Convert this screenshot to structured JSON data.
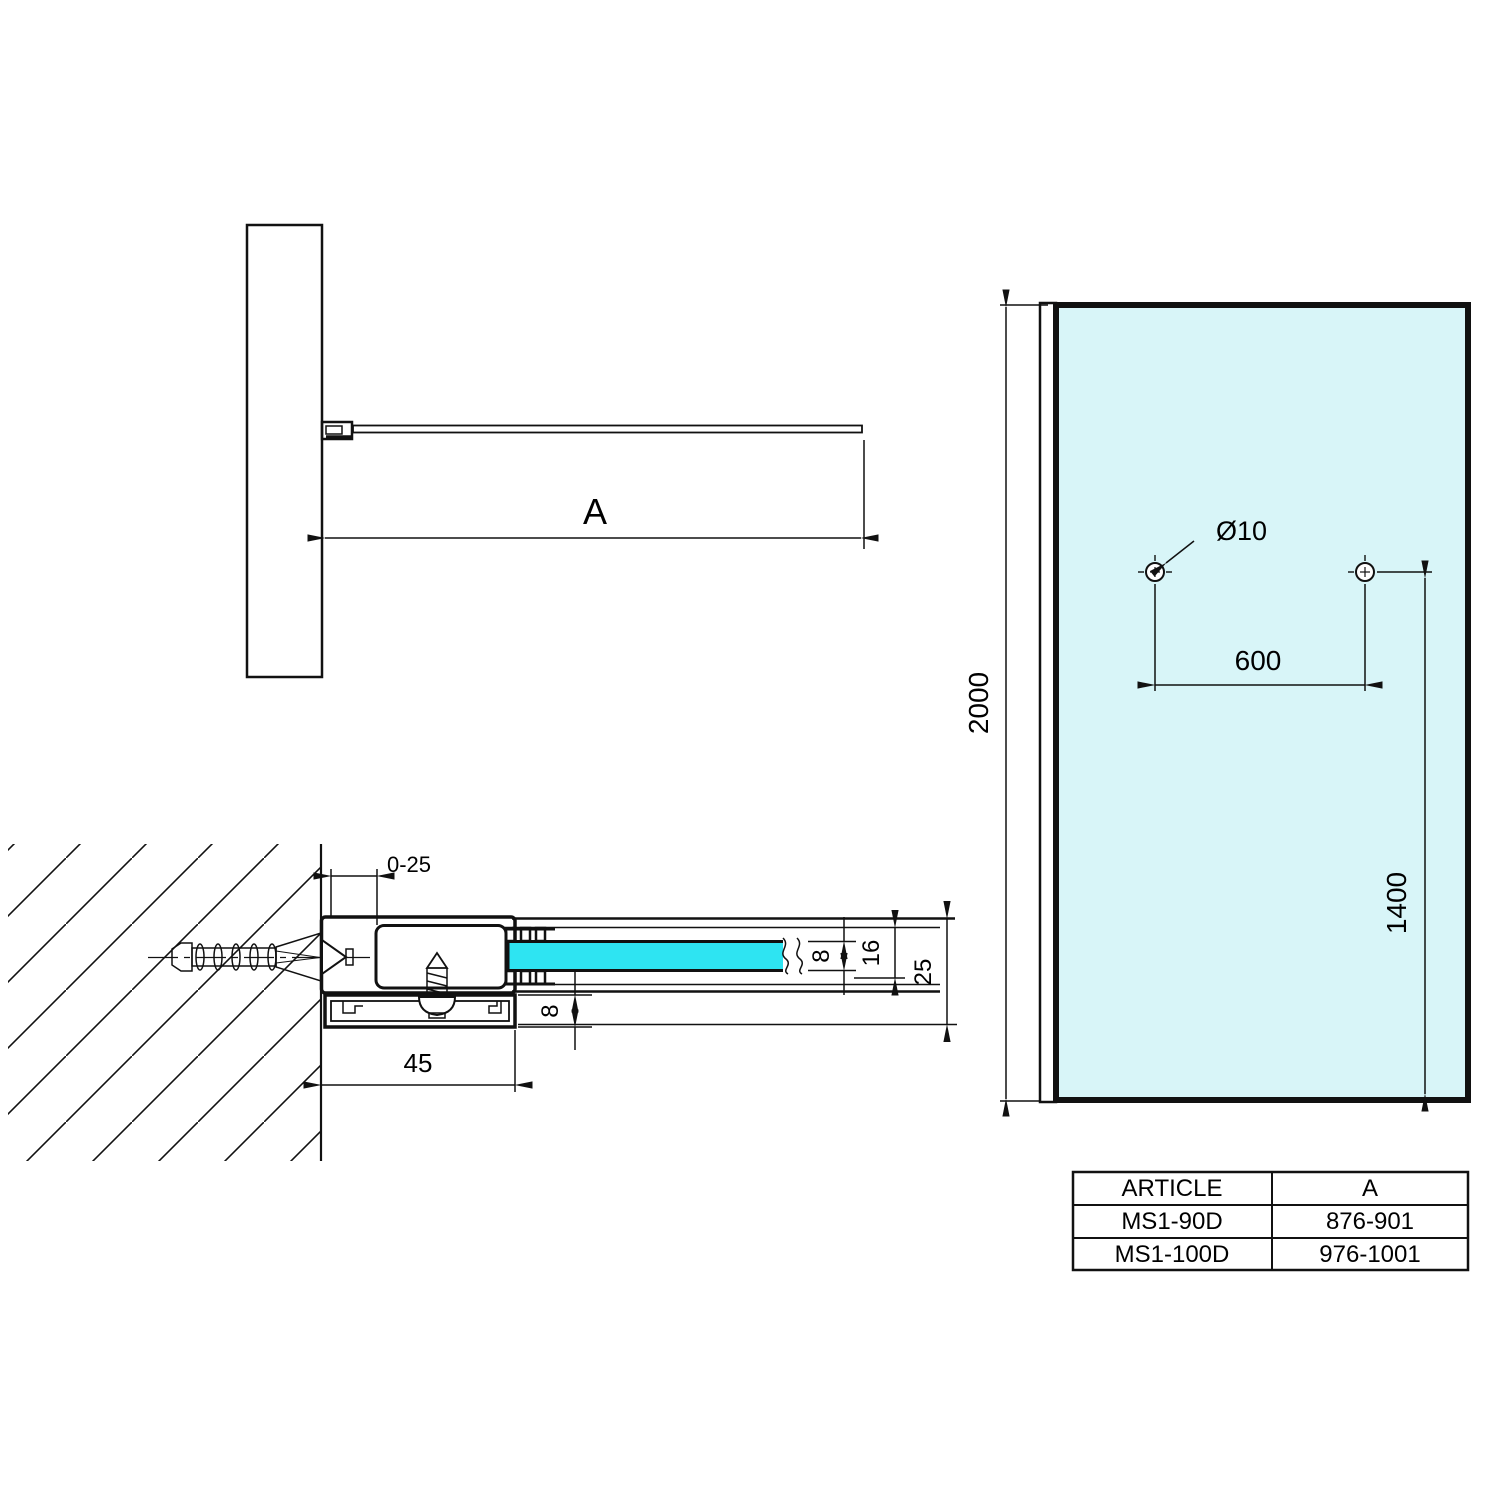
{
  "drawing": {
    "background": "#ffffff",
    "line_color": "#111111",
    "glass_section_color": "#2ee4f2",
    "glass_panel_color": "#d8f5f8",
    "labels": {
      "dim_a": "A",
      "adjust_range": "0-25",
      "profile_width": "45",
      "rail_height": "8",
      "glass_thickness": "8",
      "channel_height": "16",
      "profile_depth": "25",
      "panel_height": "2000",
      "hole_spacing": "600",
      "hole_height": "1400",
      "hole_diameter": "Ø10"
    },
    "table": {
      "headers": [
        "ARTICLE",
        "A"
      ],
      "rows": [
        [
          "MS1-90D",
          "876-901"
        ],
        [
          "MS1-100D",
          "976-1001"
        ]
      ]
    }
  }
}
